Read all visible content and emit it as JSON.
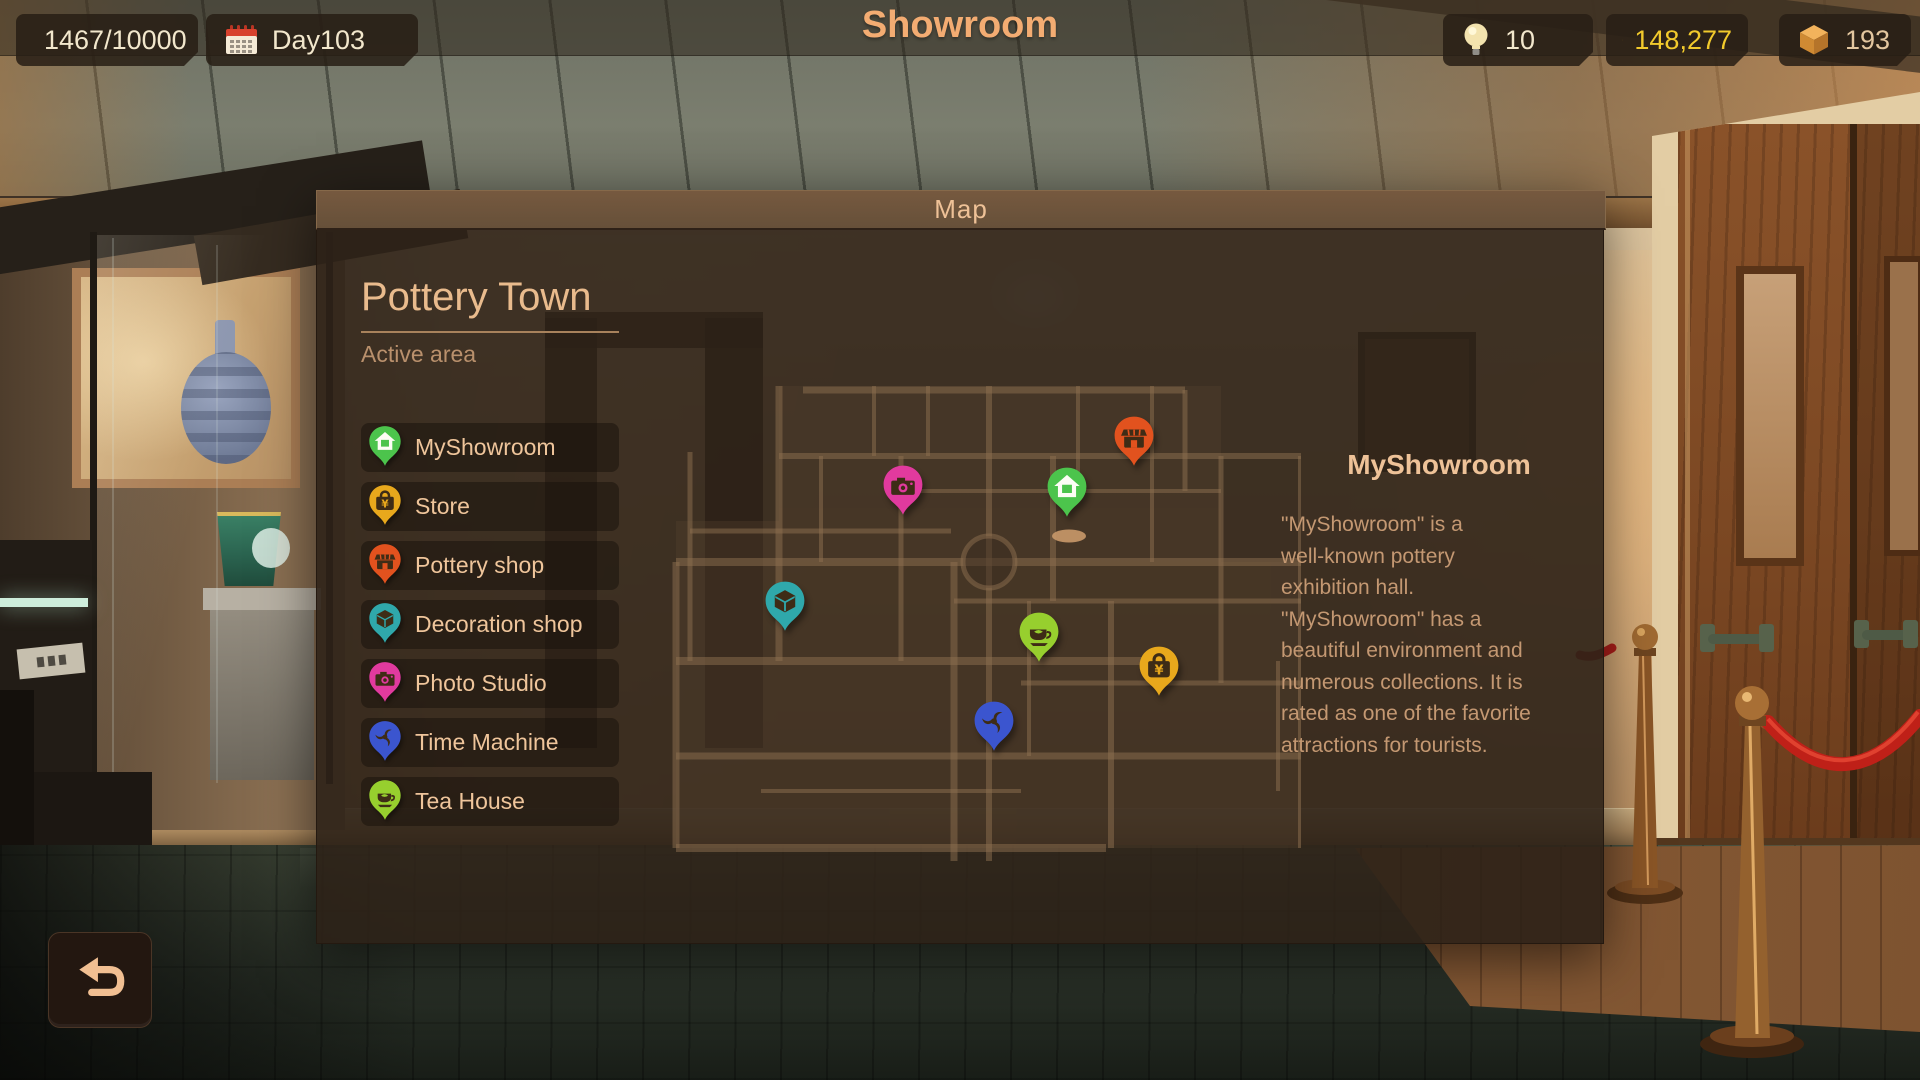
{
  "top_bar": {
    "title": "Showroom",
    "level": {
      "value": "9",
      "progress": "1467/10000",
      "icon": "level-badge"
    },
    "day": {
      "label": "Day103",
      "icon": "calendar-icon"
    },
    "resources": [
      {
        "icon": "lightbulb-icon",
        "value": "10"
      },
      {
        "icon": "coin-yen-icon",
        "value": "148,277",
        "color": "#f2ca2c"
      },
      {
        "icon": "clay-cube-icon",
        "value": "193"
      }
    ]
  },
  "map_panel": {
    "title": "Map",
    "area": {
      "name": "Pottery Town",
      "status": "Active area"
    },
    "legend": [
      {
        "label": "MyShowroom",
        "color": "#4cc44c",
        "icon": "house-pin-icon"
      },
      {
        "label": "Store",
        "color": "#e8a81c",
        "icon": "shop-bag-pin-icon"
      },
      {
        "label": "Pottery shop",
        "color": "#e2521e",
        "icon": "storefront-pin-icon"
      },
      {
        "label": "Decoration shop",
        "color": "#2fa8ab",
        "icon": "decor-box-pin-icon"
      },
      {
        "label": "Photo Studio",
        "color": "#e13a9e",
        "icon": "camera-pin-icon"
      },
      {
        "label": "Time Machine",
        "color": "#3b55cf",
        "icon": "vortex-pin-icon"
      },
      {
        "label": "Tea House",
        "color": "#97cf2e",
        "icon": "teacup-pin-icon"
      }
    ],
    "pins": [
      {
        "name": "MyShowroom",
        "color": "#4cc44c",
        "icon": "house-pin-icon",
        "x": 406,
        "y": 126
      },
      {
        "name": "Store",
        "color": "#e8a81c",
        "icon": "shop-bag-pin-icon",
        "x": 498,
        "y": 305
      },
      {
        "name": "Pottery shop",
        "color": "#e2521e",
        "icon": "storefront-pin-icon",
        "x": 473,
        "y": 75
      },
      {
        "name": "Decoration shop",
        "color": "#2fa8ab",
        "icon": "decor-box-pin-icon",
        "x": 124,
        "y": 240
      },
      {
        "name": "Photo Studio",
        "color": "#e13a9e",
        "icon": "camera-pin-icon",
        "x": 242,
        "y": 124
      },
      {
        "name": "Time Machine",
        "color": "#3b55cf",
        "icon": "vortex-pin-icon",
        "x": 333,
        "y": 360
      },
      {
        "name": "Tea House",
        "color": "#97cf2e",
        "icon": "teacup-pin-icon",
        "x": 378,
        "y": 271
      }
    ],
    "detail": {
      "title": "MyShowroom",
      "description": "\"MyShowroom\" is a\nwell-known pottery\nexhibition hall.\n\"MyShowroom\" has a\nbeautiful environment and\nnumerous collections. It is\nrated as one of the favorite\nattractions for tourists."
    }
  },
  "back_button": {
    "icon": "return-arrow-icon"
  }
}
